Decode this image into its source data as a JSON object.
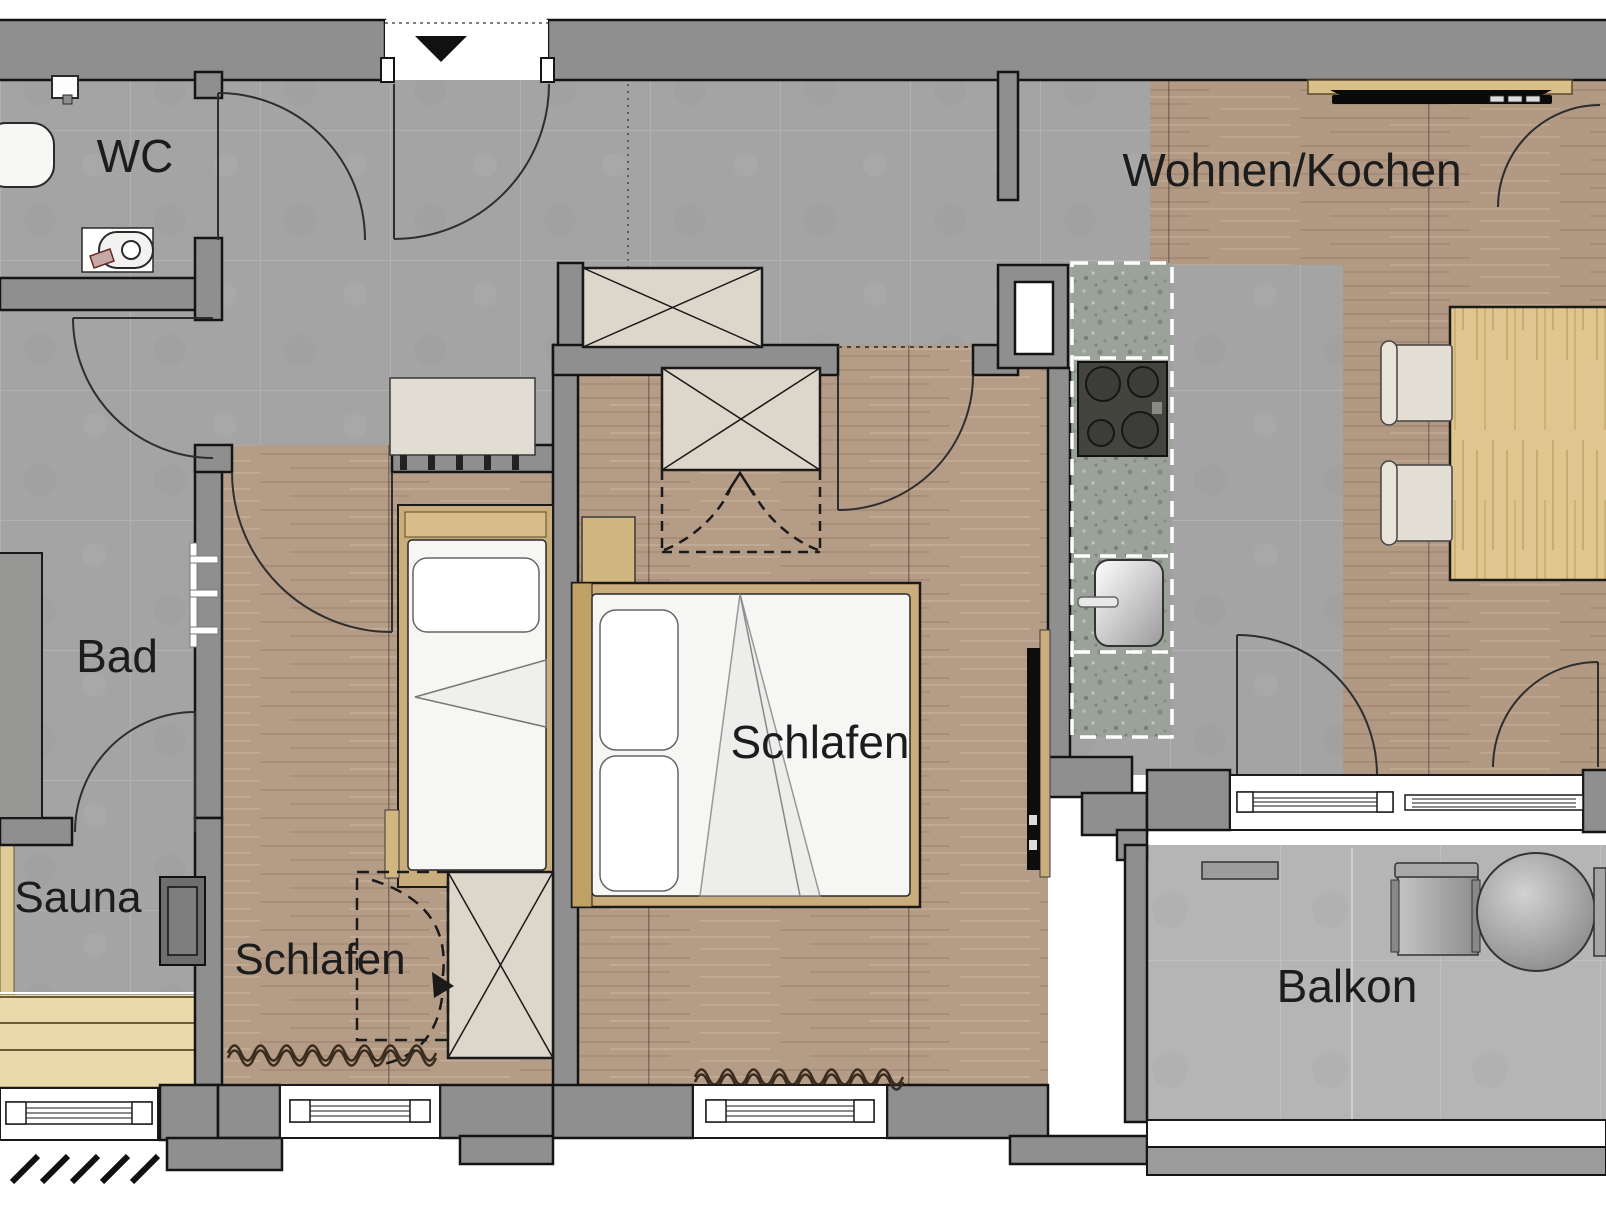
{
  "plan": {
    "rooms": {
      "wc": {
        "label": "WC"
      },
      "bathroom": {
        "label": "Bad"
      },
      "sauna": {
        "label": "Sauna"
      },
      "bedroom_small": {
        "label": "Schlafen"
      },
      "bedroom_master": {
        "label": "Schlafen"
      },
      "living_kitchen": {
        "label": "Wohnen/Kochen"
      },
      "balcony": {
        "label": "Balkon"
      }
    },
    "colors": {
      "wall": "#8f8f8f",
      "wall_outline": "#141414",
      "tile": "#a6a6a6",
      "tile_balcony": "#b5b5b5",
      "wood_floor": "#b59c87",
      "bed_frame_wood": "#c9ad7c",
      "table_wood": "#dfc68f",
      "stone_counter": "#9ba29a",
      "sauna_bench": "#ead9ab",
      "fixture_white": "#f7f7f5",
      "furniture_beige": "#ddd6ca",
      "tv_black": "#0d0d0d",
      "label_text": "#1c1c1c"
    },
    "icons": [
      "entrance-arrow-icon",
      "door-swing-arc",
      "wardrobe-x-icon",
      "window-symbol",
      "radiator-wave-icon"
    ]
  }
}
